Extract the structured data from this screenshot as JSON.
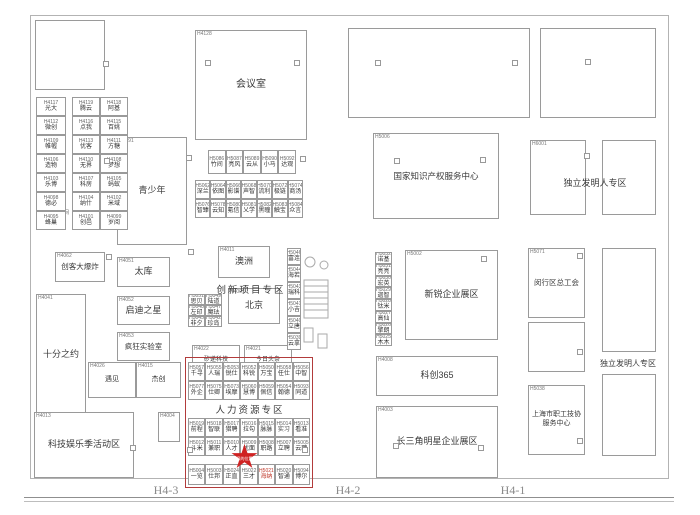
{
  "gates": {
    "left": "H4-3",
    "center": "H4-2",
    "right": "H4-1"
  },
  "marker": {
    "label": "您的位置"
  },
  "zone_labels": {
    "innovation": "创新项目专区",
    "hr": "人力资源专区",
    "coworking": "共享空间"
  },
  "rooms": {
    "meeting": {
      "code": "H4128",
      "name": "会议室"
    },
    "youth": {
      "code": "H4091",
      "name": "青少年"
    },
    "maker": {
      "code": "H4062",
      "name": "创客大爆炸"
    },
    "taiku": {
      "code": "H4051",
      "name": "太库"
    },
    "tenmin": {
      "code": "H4041",
      "name": "十分之约"
    },
    "qidi": {
      "code": "H4052",
      "name": "启迪之星"
    },
    "lab": {
      "code": "H4053",
      "name": "疯狂实验室"
    },
    "meet": {
      "code": "H4026",
      "name": "遇见"
    },
    "jiechuang": {
      "code": "H4015",
      "name": "杰创"
    },
    "techfun": {
      "code": "H4013",
      "name": "科技娱乐季活动区"
    },
    "h4004": {
      "code": "H4004",
      "name": ""
    },
    "australia": {
      "code": "H4011",
      "name": "澳洲"
    },
    "beijing": {
      "code": "H4001",
      "name": "北京"
    },
    "seeed": {
      "code": "H4022",
      "name": "矽递科技"
    },
    "media": {
      "code": "H4021",
      "name": "今日头条"
    },
    "ip": {
      "code": "H5006",
      "name": "国家知识产权服务中心"
    },
    "newstar": {
      "code": "H5002",
      "name": "新锐企业展区"
    },
    "kc365": {
      "code": "H4008",
      "name": "科创365"
    },
    "delta": {
      "code": "H4003",
      "name": "长三角明星企业展区"
    },
    "indep_top": {
      "code": "H6001",
      "name": "独立发明人专区"
    },
    "minhang": {
      "code": "H5071",
      "name": "闵行区总工会"
    },
    "workers": {
      "code": "H5038",
      "name": "上海市职工技协服务中心"
    },
    "indep_right": {
      "name": "独立发明人专区"
    }
  },
  "booths": {
    "left_col": {
      "cells": [
        {
          "code": "H4117",
          "name": "光大"
        },
        {
          "code": "H4112",
          "name": "微创"
        },
        {
          "code": "H4109",
          "name": "帷幄"
        },
        {
          "code": "H4106",
          "name": "造物"
        },
        {
          "code": "H4103",
          "name": "乐博"
        },
        {
          "code": "H4098",
          "name": "德必"
        },
        {
          "code": "H4095",
          "name": "蜂巢"
        }
      ]
    },
    "left_grid": {
      "cells": [
        {
          "code": "H4119",
          "name": "腾云"
        },
        {
          "code": "H4118",
          "name": "阿基"
        },
        {
          "code": "H4116",
          "name": "点我"
        },
        {
          "code": "H4115",
          "name": "百姚"
        },
        {
          "code": "H4113",
          "name": "优客"
        },
        {
          "code": "H4111",
          "name": "方糖"
        },
        {
          "code": "H4110",
          "name": "无界"
        },
        {
          "code": "H4108",
          "name": "梦想"
        },
        {
          "code": "H4107",
          "name": "科房"
        },
        {
          "code": "H4105",
          "name": "蚂蚁"
        },
        {
          "code": "H4104",
          "name": "纳什"
        },
        {
          "code": "H4102",
          "name": "米域"
        },
        {
          "code": "H4101",
          "name": "创邑"
        },
        {
          "code": "H4099",
          "name": "岁阅"
        }
      ]
    },
    "mid_row_a": {
      "cells": [
        {
          "code": "H5086",
          "name": "竹间"
        },
        {
          "code": "H5087",
          "name": "亮风"
        },
        {
          "code": "H5089",
          "name": "云从"
        },
        {
          "code": "H5090",
          "name": "小马"
        },
        {
          "code": "H5092",
          "name": "达观"
        }
      ]
    },
    "mid_grid_b": {
      "cells": [
        {
          "code": "H5062",
          "name": "深兰"
        },
        {
          "code": "H5064",
          "name": "依图"
        },
        {
          "code": "H5066",
          "name": "影谱"
        },
        {
          "code": "H5068",
          "name": "声智"
        },
        {
          "code": "H5070",
          "name": "流利"
        },
        {
          "code": "H5072",
          "name": "极链"
        },
        {
          "code": "H5074",
          "name": "商汤"
        },
        {
          "code": "H5076",
          "name": "智臻"
        },
        {
          "code": "H5078",
          "name": "云知"
        },
        {
          "code": "H5080",
          "name": "氪信"
        },
        {
          "code": "H5081",
          "name": "乂学"
        },
        {
          "code": "H5082",
          "name": "黑瞳"
        },
        {
          "code": "H5083",
          "name": "触宝"
        },
        {
          "code": "H5084",
          "name": "众言"
        }
      ]
    },
    "tiny_grid_c": {
      "cells": [
        {
          "code": "H5051",
          "name": "思贝"
        },
        {
          "code": "H5049",
          "name": "陆道"
        },
        {
          "code": "H5048",
          "name": "左印"
        },
        {
          "code": "H5047",
          "name": "魔珐"
        },
        {
          "code": "H5045",
          "name": "非夕"
        },
        {
          "code": "H5042",
          "name": "珍岛"
        }
      ]
    },
    "stairs_col": {
      "cells": [
        {
          "code": "H5046",
          "name": "富连"
        },
        {
          "code": "H5044",
          "name": "海若"
        },
        {
          "code": "H5043",
          "name": "瑞科"
        },
        {
          "code": "H5041",
          "name": "小吉"
        },
        {
          "code": "H5040",
          "name": "立唐"
        },
        {
          "code": "H5039",
          "name": "云拿"
        }
      ]
    },
    "right_strip": {
      "cells": [
        {
          "code": "H5032",
          "name": "诺基"
        },
        {
          "code": "H5031",
          "name": "亮亮"
        },
        {
          "code": "H5030",
          "name": "宏英"
        },
        {
          "code": "H5029",
          "name": "迦智"
        },
        {
          "code": "H5028",
          "name": "钛米"
        },
        {
          "code": "H5027",
          "name": "高仙"
        },
        {
          "code": "H5026",
          "name": "擎朗"
        },
        {
          "code": "H5025",
          "name": "木木"
        }
      ]
    },
    "hr_top": {
      "cells": [
        {
          "code": "H5057",
          "name": "千寻"
        },
        {
          "code": "H5055",
          "name": "人瑞"
        },
        {
          "code": "H5053",
          "name": "锐仕"
        },
        {
          "code": "H5052",
          "name": "科锐"
        },
        {
          "code": "H5050",
          "name": "万宝"
        },
        {
          "code": "H5058",
          "name": "任仕"
        },
        {
          "code": "H5056",
          "name": "中智"
        },
        {
          "code": "H5077",
          "name": "外企"
        },
        {
          "code": "H5075",
          "name": "仕卿"
        },
        {
          "code": "H5073",
          "name": "埃摩"
        },
        {
          "code": "H5060",
          "name": "慧博"
        },
        {
          "code": "H5059",
          "name": "佩信"
        },
        {
          "code": "H5054",
          "name": "翰德"
        },
        {
          "code": "H5093",
          "name": "同道"
        }
      ]
    },
    "hr_mid": {
      "cells": [
        {
          "code": "H5019",
          "name": "前程"
        },
        {
          "code": "H5018",
          "name": "智联"
        },
        {
          "code": "H5017",
          "name": "猎聘"
        },
        {
          "code": "H5016",
          "name": "拉勾"
        },
        {
          "code": "H5015",
          "name": "脉脉"
        },
        {
          "code": "H5014",
          "name": "实习"
        },
        {
          "code": "H5013",
          "name": "看准"
        },
        {
          "code": "H5012",
          "name": "斗米"
        },
        {
          "code": "H5011",
          "name": "兼职"
        },
        {
          "code": "H5010",
          "name": "人才"
        },
        {
          "code": "H5009",
          "name": "优面"
        },
        {
          "code": "H5008",
          "name": "职路"
        },
        {
          "code": "H5007",
          "name": "立聘"
        },
        {
          "code": "H5005",
          "name": "云聘"
        }
      ]
    },
    "hr_bot": {
      "cells": [
        {
          "code": "H5004",
          "name": "一览"
        },
        {
          "code": "H5003",
          "name": "仕邦"
        },
        {
          "code": "H5024",
          "name": "正直"
        },
        {
          "code": "H5022",
          "name": "三才"
        },
        {
          "code": "H5021",
          "name": "海纳",
          "red": true
        },
        {
          "code": "H5020",
          "name": "智通"
        },
        {
          "code": "H5094",
          "name": "博尔"
        }
      ]
    }
  }
}
